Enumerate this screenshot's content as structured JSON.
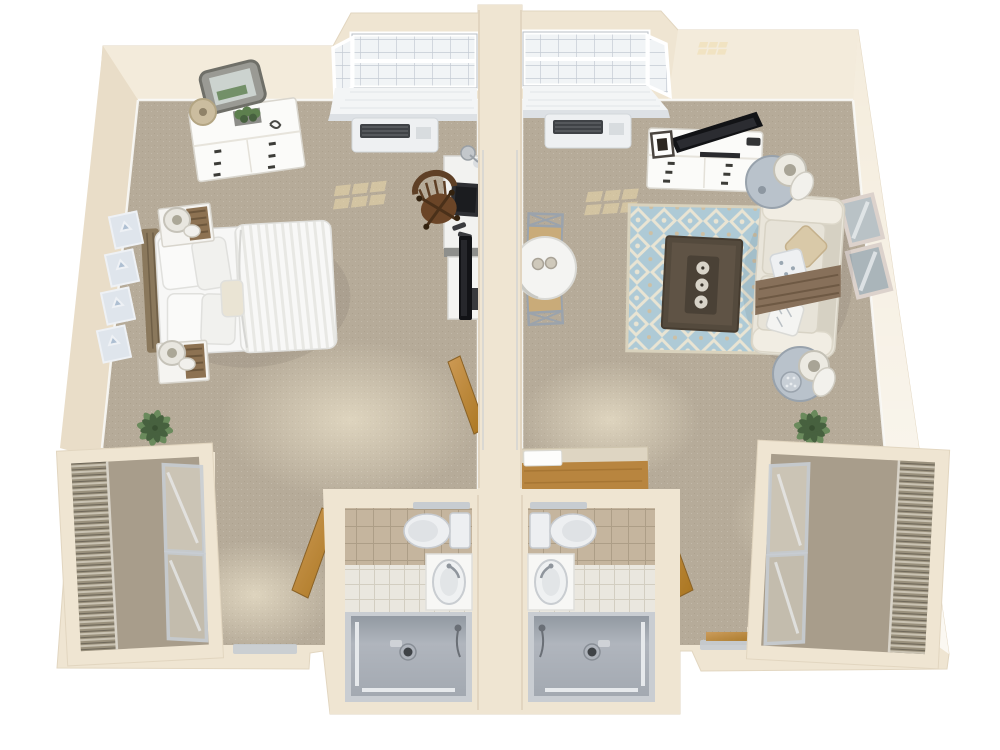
{
  "scene": {
    "type": "3d-floor-plan",
    "description": "Top-down 3D rendered floor plan of two mirrored studio apartments separated by a center wall, each with bay window, wall air-conditioning unit, private accessible bathroom with roll-in shower, sliding-door closet and entry",
    "units": [
      {
        "id": "left-studio",
        "rooms": [
          "main-room",
          "bathroom",
          "closet",
          "entry"
        ],
        "furniture": [
          "dresser",
          "ornate-mirror",
          "table-lamp",
          "planter-box",
          "bay-window",
          "ptac-ac-unit",
          "desk",
          "desk-lamp",
          "laptop",
          "wood-desk-chair",
          "tv-stand",
          "flat-tv",
          "queen-bed",
          "wood-headboard",
          "pillows",
          "striped-duvet",
          "nightstand",
          "nightstand-lamp",
          "wall-art-frames",
          "floor-plant",
          "entry-door",
          "bathroom-door",
          "sliding-closet-doors",
          "wire-shelving",
          "toilet",
          "vanity-sink",
          "roll-in-shower",
          "grab-bars"
        ]
      },
      {
        "id": "right-studio",
        "rooms": [
          "main-room",
          "bathroom",
          "closet",
          "entry"
        ],
        "furniture": [
          "bay-window",
          "ptac-ac-unit",
          "media-dresser",
          "flat-screen-tv",
          "picture-frame",
          "round-dining-table",
          "cross-back-chair",
          "coffee-cups",
          "trellis-area-rug",
          "coffee-table",
          "candles",
          "loveseat-sofa",
          "throw-pillows",
          "throw-blanket",
          "round-side-table",
          "table-lamp",
          "wall-mirrors",
          "kitchenette-counter",
          "floor-plant",
          "entry-door",
          "bathroom-door",
          "sliding-closet-doors",
          "wire-shelving",
          "toilet",
          "vanity-sink",
          "roll-in-shower",
          "grab-bars"
        ]
      }
    ],
    "counts": {
      "bathrooms": 2,
      "bay_windows": 2,
      "beds": 1,
      "sofas": 1,
      "closets": 2
    }
  },
  "palette": {
    "background": "#ffffff",
    "wall": "#efe5d2",
    "wallFace": "#f3ebdb",
    "wallShadow": "#ddcfb6",
    "carpet": "#b6ab99",
    "carpetDark": "#a89d8b",
    "baseboard": "#fafaf7",
    "trimSilver": "#c7ccd1",
    "glass": "#f1f4f6",
    "windowSeat": "#f3f5f6",
    "ptacBody": "#eef0f2",
    "ptacVent": "#3f4246",
    "tileTan": "#c5b59e",
    "tileGrout": "#ad9e87",
    "tileWhite": "#eae7df",
    "showerPan": "#adb2ba",
    "showerWall": "#878d96",
    "fixture": "#edeff1",
    "wood": "#b8853f",
    "woodDark": "#8a6226",
    "tv": "#121316",
    "sofa": "#e9e5da",
    "sofaTrim": "#d6d1c3",
    "throw": "#87705a",
    "pillowTan": "#d9c9a8",
    "rugBlue": "#aecad6",
    "rugCream": "#e9e4d3",
    "coffeeTable": "#544a3d",
    "chairWood": "#5f4026",
    "metal": "#9ba3ac",
    "lampShade": "#e8e6dd",
    "plant": "#6a8a5c",
    "plantDark": "#47613f",
    "bedWhite": "#f7f7f6",
    "bedStripe": "#e8e8e4",
    "headboard": "#8a785c",
    "artFrame": "#dfe5ec",
    "sunlight": "#eedfae"
  }
}
